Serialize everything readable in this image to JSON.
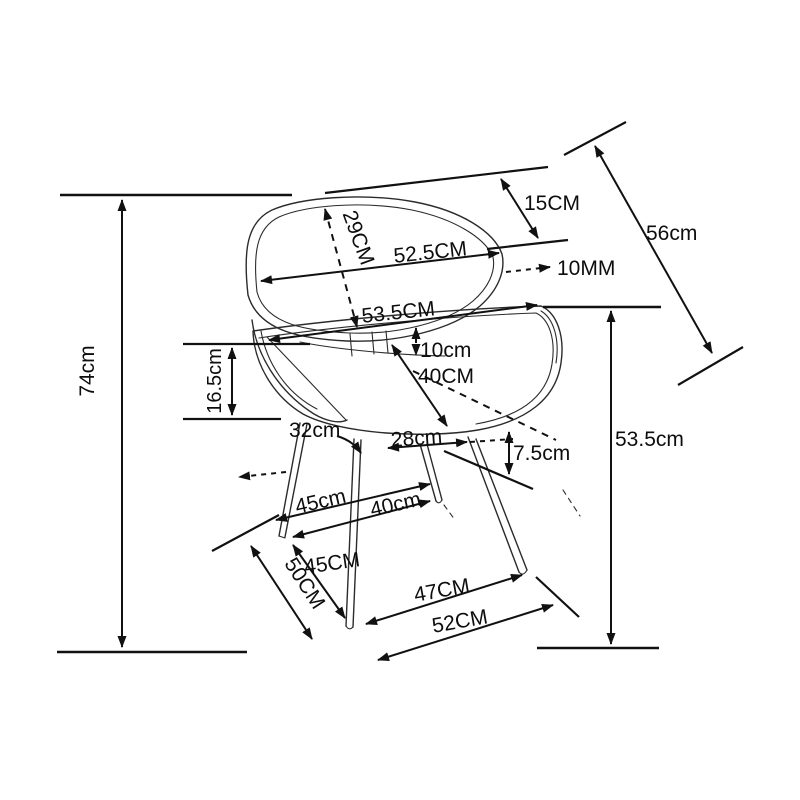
{
  "figure": {
    "kind": "product dimension diagram",
    "subject": "chair line drawing with measurement callouts",
    "background_color": "#ffffff",
    "line_color": "#111111",
    "text_color": "#0d0d0d"
  },
  "labels": {
    "d15cm": "15CM",
    "d56cm": "56cm",
    "d29cm": "29CM",
    "d52_5cm": "52.5CM",
    "d10mm": "10MM",
    "d53_5cm_upper": "53.5CM",
    "d10cm": "10cm",
    "d40cm_upper": "40CM",
    "d74cm": "74cm",
    "d16_5cm": "16.5cm",
    "d32cm": "32cm",
    "d28cm": "28cm",
    "d7_5cm": "7.5cm",
    "d53_5cm_right": "53.5cm",
    "d45cm_lower": "45cm",
    "d40cm_lower": "40cm",
    "d45cm_diag": "45CM",
    "d50cm": "50CM",
    "d47cm": "47CM",
    "d52cm": "52CM"
  }
}
